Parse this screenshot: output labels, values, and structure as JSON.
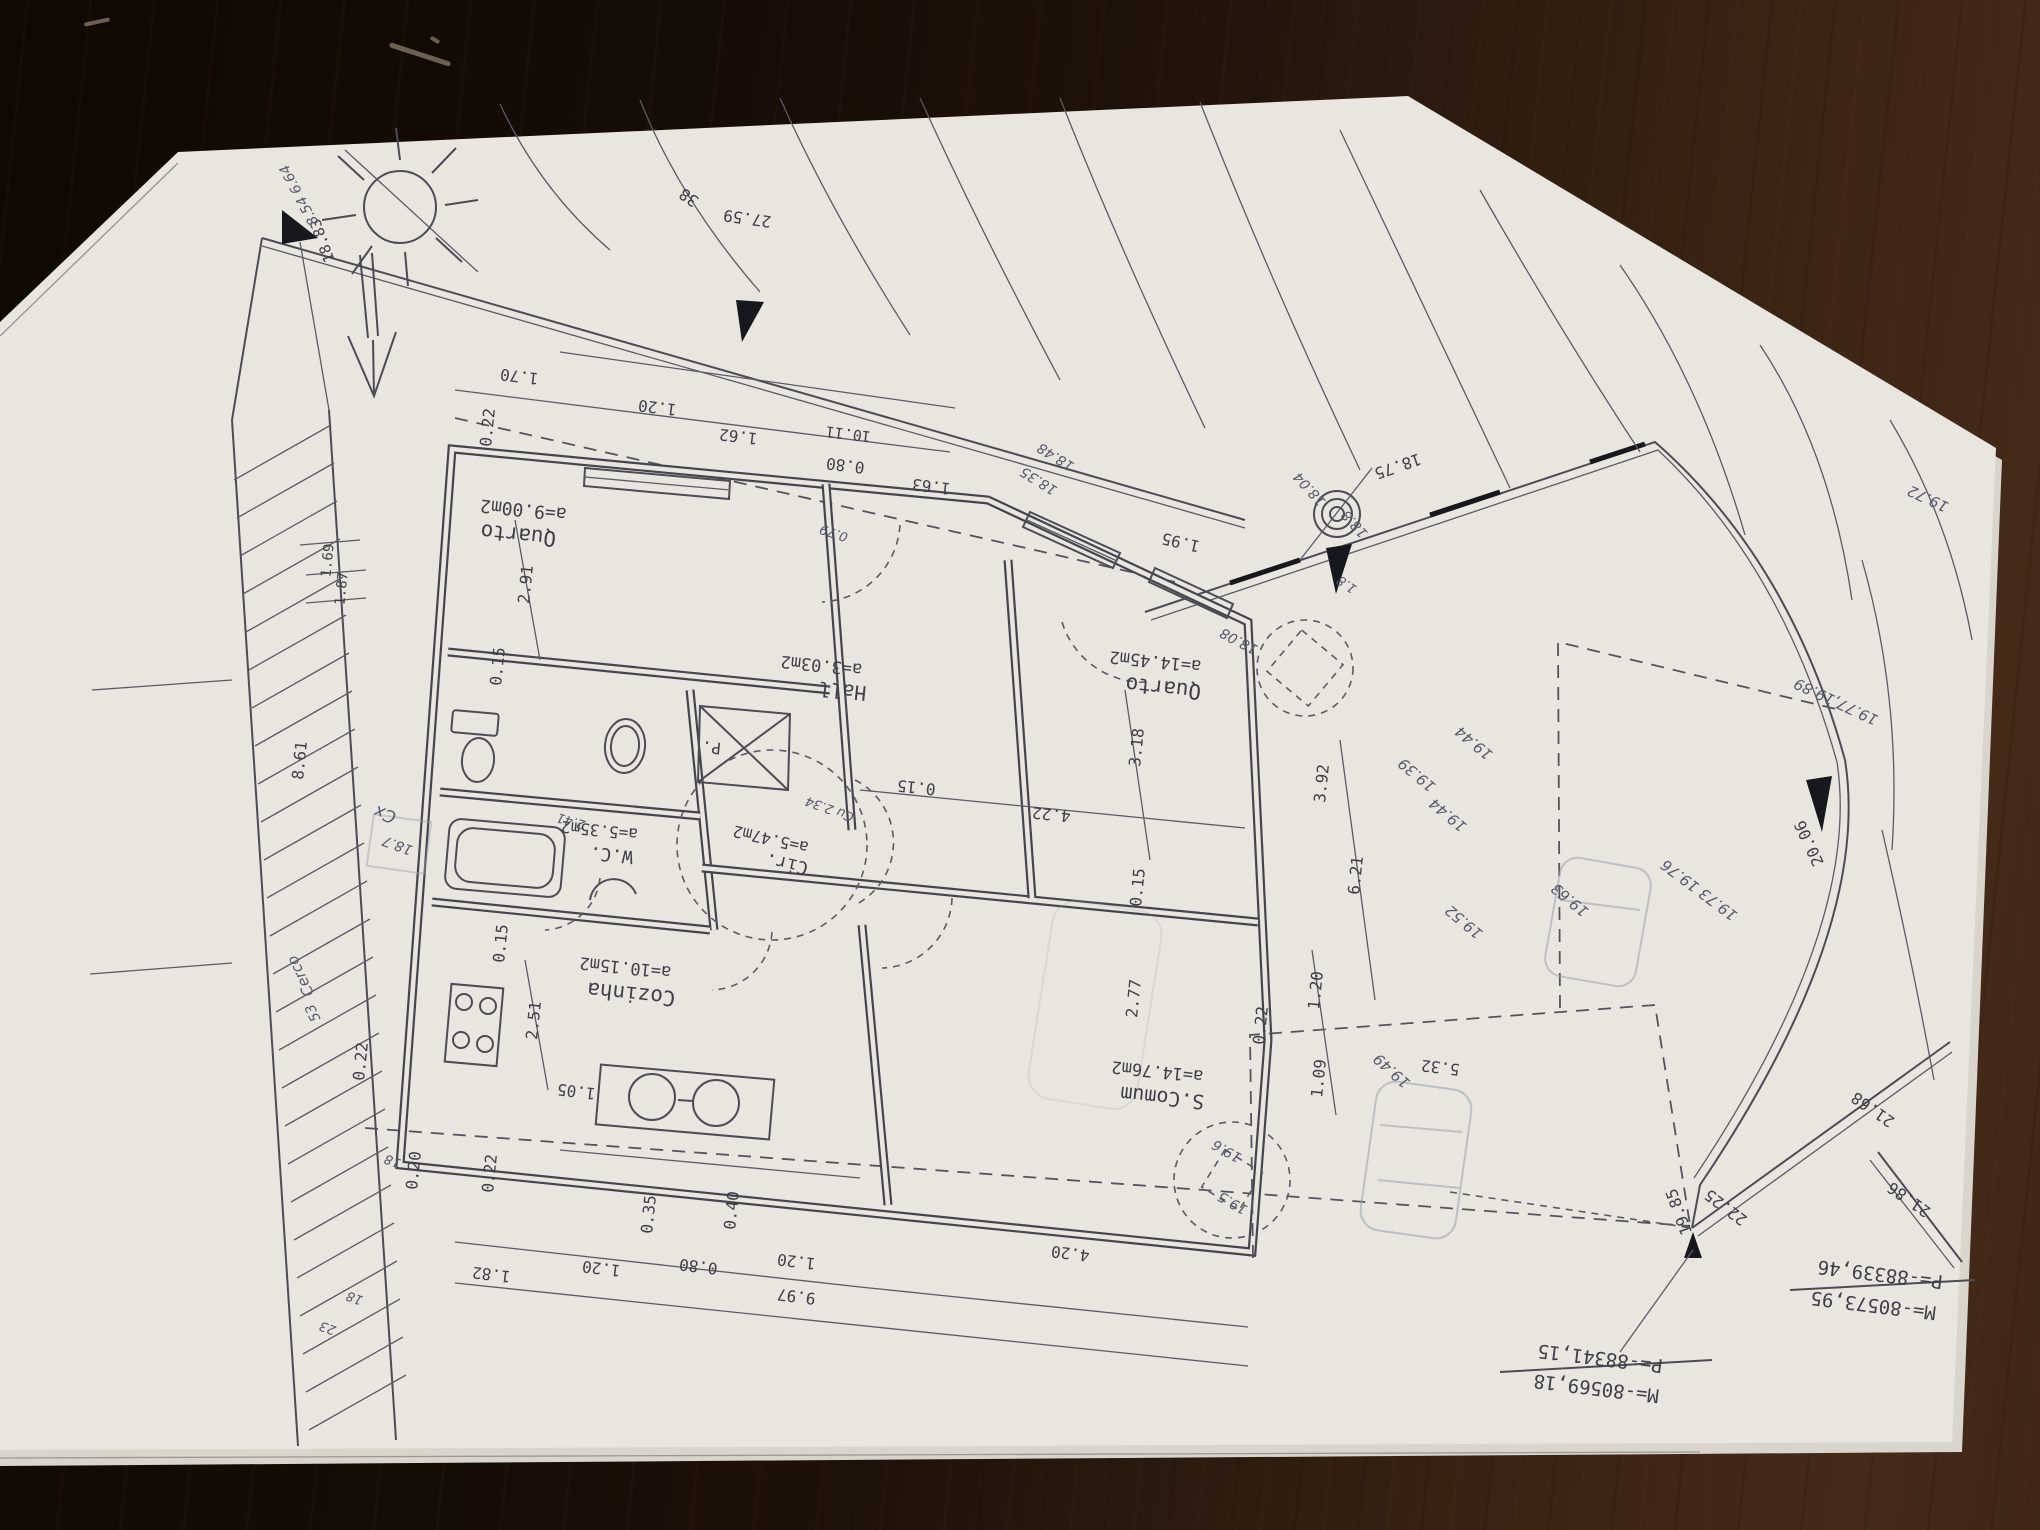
{
  "scene": {
    "paper_color": "#e9e6df",
    "ink_color": "#4b4c55",
    "pencil_color": "#9aa0ac",
    "table_color": "#2b1a0e"
  },
  "plan": {
    "printed_labels": [
      {
        "n": "room-area",
        "t": "a=9.00m2",
        "x": 524,
        "y": 504,
        "a": 186,
        "s": 18
      },
      {
        "n": "room-name",
        "t": "Quarto",
        "x": 519,
        "y": 528,
        "a": 186,
        "s": 21
      },
      {
        "n": "room-area",
        "t": "a=3.03m2",
        "x": 822,
        "y": 660,
        "a": 186,
        "s": 17
      },
      {
        "n": "room-name",
        "t": "Hall",
        "x": 843,
        "y": 684,
        "a": 186,
        "s": 20
      },
      {
        "n": "room-area",
        "t": "a=14.45m2",
        "x": 1156,
        "y": 656,
        "a": 186,
        "s": 17
      },
      {
        "n": "room-name",
        "t": "Quarto",
        "x": 1164,
        "y": 681,
        "a": 186,
        "s": 21
      },
      {
        "n": "room-area",
        "t": "a=5.35m2",
        "x": 600,
        "y": 825,
        "a": 186,
        "s": 16
      },
      {
        "n": "room-name",
        "t": "W.C.",
        "x": 612,
        "y": 849,
        "a": 186,
        "s": 18
      },
      {
        "n": "room-area",
        "t": "a=5.47m2",
        "x": 772,
        "y": 834,
        "a": 193,
        "s": 16
      },
      {
        "n": "room-name",
        "t": "Cir.",
        "x": 788,
        "y": 858,
        "a": 193,
        "s": 18
      },
      {
        "n": "room-area",
        "t": "a=10.15m2",
        "x": 626,
        "y": 962,
        "a": 186,
        "s": 17
      },
      {
        "n": "room-name",
        "t": "Cozinha",
        "x": 632,
        "y": 987,
        "a": 186,
        "s": 21
      },
      {
        "n": "room-area",
        "t": "a=14.76m2",
        "x": 1158,
        "y": 1066,
        "a": 186,
        "s": 17
      },
      {
        "n": "room-name",
        "t": "S.Comum",
        "x": 1163,
        "y": 1091,
        "a": 186,
        "s": 20
      },
      {
        "n": "room-name",
        "t": "P.",
        "x": 712,
        "y": 742,
        "a": 186,
        "s": 16
      },
      {
        "n": "dimension",
        "t": "0.22",
        "x": 493,
        "y": 428,
        "a": 276,
        "s": 16
      },
      {
        "n": "dimension",
        "t": "1.70",
        "x": 520,
        "y": 371,
        "a": 187,
        "s": 16
      },
      {
        "n": "dimension",
        "t": "1.20",
        "x": 658,
        "y": 402,
        "a": 187,
        "s": 16
      },
      {
        "n": "dimension",
        "t": "1.62",
        "x": 739,
        "y": 431,
        "a": 187,
        "s": 16
      },
      {
        "n": "dimension",
        "t": "10.11",
        "x": 849,
        "y": 429,
        "a": 187,
        "s": 15
      },
      {
        "n": "dimension",
        "t": "0.80",
        "x": 846,
        "y": 460,
        "a": 187,
        "s": 16
      },
      {
        "n": "dimension",
        "t": "1.63",
        "x": 932,
        "y": 481,
        "a": 187,
        "s": 16
      },
      {
        "n": "dimension",
        "t": "27.59",
        "x": 748,
        "y": 213,
        "a": 188,
        "s": 16
      },
      {
        "n": "dimension",
        "t": "38",
        "x": 692,
        "y": 193,
        "a": 215,
        "s": 16
      },
      {
        "n": "dimension",
        "t": "2.91",
        "x": 531,
        "y": 585,
        "a": 276,
        "s": 16
      },
      {
        "n": "dimension",
        "t": "0.15",
        "x": 503,
        "y": 667,
        "a": 276,
        "s": 16
      },
      {
        "n": "dimension",
        "t": "1.95",
        "x": 1182,
        "y": 537,
        "a": 193,
        "s": 16
      },
      {
        "n": "dimension",
        "t": "18.75",
        "x": 1396,
        "y": 461,
        "a": 161,
        "s": 16
      },
      {
        "n": "dimension",
        "t": "0.15",
        "x": 917,
        "y": 782,
        "a": 186,
        "s": 16
      },
      {
        "n": "dimension",
        "t": "4.22",
        "x": 1052,
        "y": 809,
        "a": 186,
        "s": 16
      },
      {
        "n": "dimension",
        "t": "3.18",
        "x": 1142,
        "y": 748,
        "a": 276,
        "s": 16
      },
      {
        "n": "dimension",
        "t": "0.15",
        "x": 1143,
        "y": 888,
        "a": 276,
        "s": 16
      },
      {
        "n": "dimension",
        "t": "3.92",
        "x": 1327,
        "y": 784,
        "a": 276,
        "s": 16
      },
      {
        "n": "dimension",
        "t": "6.21",
        "x": 1361,
        "y": 876,
        "a": 276,
        "s": 16
      },
      {
        "n": "dimension",
        "t": "2.77",
        "x": 1139,
        "y": 999,
        "a": 276,
        "s": 16
      },
      {
        "n": "dimension",
        "t": "1.20",
        "x": 1321,
        "y": 991,
        "a": 276,
        "s": 16
      },
      {
        "n": "dimension",
        "t": "0.22",
        "x": 1266,
        "y": 1026,
        "a": 276,
        "s": 16
      },
      {
        "n": "dimension",
        "t": "1.09",
        "x": 1324,
        "y": 1079,
        "a": 276,
        "s": 16
      },
      {
        "n": "dimension",
        "t": "5.32",
        "x": 1441,
        "y": 1062,
        "a": 187,
        "s": 16
      },
      {
        "n": "dimension",
        "t": "0.15",
        "x": 506,
        "y": 944,
        "a": 276,
        "s": 16
      },
      {
        "n": "dimension",
        "t": "2.51",
        "x": 539,
        "y": 1021,
        "a": 276,
        "s": 16
      },
      {
        "n": "dimension",
        "t": "0.22",
        "x": 366,
        "y": 1062,
        "a": 276,
        "s": 16
      },
      {
        "n": "dimension",
        "t": "0.20",
        "x": 419,
        "y": 1171,
        "a": 276,
        "s": 16
      },
      {
        "n": "dimension",
        "t": "0.22",
        "x": 495,
        "y": 1174,
        "a": 276,
        "s": 16
      },
      {
        "n": "dimension",
        "t": "1.05",
        "x": 577,
        "y": 1086,
        "a": 187,
        "s": 16
      },
      {
        "n": "dimension",
        "t": "1.82",
        "x": 492,
        "y": 1269,
        "a": 187,
        "s": 16
      },
      {
        "n": "dimension",
        "t": "1.20",
        "x": 602,
        "y": 1263,
        "a": 187,
        "s": 16
      },
      {
        "n": "dimension",
        "t": "0.35",
        "x": 654,
        "y": 1215,
        "a": 276,
        "s": 16
      },
      {
        "n": "dimension",
        "t": "0.80",
        "x": 699,
        "y": 1261,
        "a": 187,
        "s": 16
      },
      {
        "n": "dimension",
        "t": "0.40",
        "x": 737,
        "y": 1211,
        "a": 276,
        "s": 16
      },
      {
        "n": "dimension",
        "t": "1.20",
        "x": 797,
        "y": 1256,
        "a": 187,
        "s": 16
      },
      {
        "n": "dimension",
        "t": "4.20",
        "x": 1071,
        "y": 1248,
        "a": 187,
        "s": 16
      },
      {
        "n": "dimension",
        "t": "9.97",
        "x": 797,
        "y": 1291,
        "a": 187,
        "s": 16
      },
      {
        "n": "dimension",
        "t": "8.61",
        "x": 305,
        "y": 761,
        "a": 276,
        "s": 16
      },
      {
        "n": "dimension",
        "t": "1.69",
        "x": 332,
        "y": 561,
        "a": 276,
        "s": 14
      },
      {
        "n": "dimension",
        "t": "1.87",
        "x": 346,
        "y": 589,
        "a": 276,
        "s": 14
      },
      {
        "n": "dimension",
        "t": "20.06",
        "x": 1814,
        "y": 841,
        "a": 245,
        "s": 16
      },
      {
        "n": "dimension",
        "t": "19.85",
        "x": 1684,
        "y": 1210,
        "a": 250,
        "s": 16
      },
      {
        "n": "dimension",
        "t": "22.25",
        "x": 1729,
        "y": 1203,
        "a": 217,
        "s": 16
      },
      {
        "n": "dimension",
        "t": "21.68",
        "x": 1876,
        "y": 1105,
        "a": 215,
        "s": 16
      },
      {
        "n": "dimension",
        "t": "21.86",
        "x": 1912,
        "y": 1195,
        "a": 215,
        "s": 16
      },
      {
        "n": "dimension",
        "t": "18.83",
        "x": 327,
        "y": 239,
        "a": 250,
        "s": 15
      },
      {
        "n": "survey-coordinate",
        "t": "P=-88341,15",
        "x": 1601,
        "y": 1352,
        "a": 187,
        "s": 19
      },
      {
        "n": "survey-coordinate",
        "t": "M=-80569,18",
        "x": 1597,
        "y": 1382,
        "a": 187,
        "s": 19
      },
      {
        "n": "survey-coordinate",
        "t": "P=-88339,46",
        "x": 1881,
        "y": 1268,
        "a": 187,
        "s": 19
      },
      {
        "n": "survey-coordinate",
        "t": "M=-80573,95",
        "x": 1874,
        "y": 1299,
        "a": 187,
        "s": 19
      }
    ],
    "handwritten_labels": [
      {
        "n": "handwritten-level",
        "t": "8.54 6.64",
        "x": 303,
        "y": 193,
        "a": 242,
        "s": 14
      },
      {
        "n": "handwritten-level",
        "t": "18.48",
        "x": 1058,
        "y": 453,
        "a": 212,
        "s": 14
      },
      {
        "n": "handwritten-level",
        "t": "18.35",
        "x": 1041,
        "y": 477,
        "a": 212,
        "s": 14
      },
      {
        "n": "handwritten-level",
        "t": "18.04",
        "x": 1313,
        "y": 486,
        "a": 228,
        "s": 14
      },
      {
        "n": "handwritten-level",
        "t": "18.8",
        "x": 1358,
        "y": 521,
        "a": 228,
        "s": 14
      },
      {
        "n": "handwritten-level",
        "t": "18.08",
        "x": 1241,
        "y": 637,
        "a": 208,
        "s": 14
      },
      {
        "n": "handwritten-level",
        "t": "1.8",
        "x": 1349,
        "y": 581,
        "a": 215,
        "s": 13
      },
      {
        "n": "handwritten-level",
        "t": "19.44",
        "x": 1477,
        "y": 739,
        "a": 220,
        "s": 15
      },
      {
        "n": "handwritten-level",
        "t": "19.39",
        "x": 1420,
        "y": 771,
        "a": 220,
        "s": 15
      },
      {
        "n": "handwritten-level",
        "t": "19.44",
        "x": 1451,
        "y": 811,
        "a": 220,
        "s": 15
      },
      {
        "n": "handwritten-level",
        "t": "19.52",
        "x": 1467,
        "y": 918,
        "a": 220,
        "s": 15
      },
      {
        "n": "handwritten-level",
        "t": "19.49",
        "x": 1395,
        "y": 1067,
        "a": 222,
        "s": 15
      },
      {
        "n": "handwritten-level",
        "t": "19.63",
        "x": 1573,
        "y": 896,
        "a": 220,
        "s": 15
      },
      {
        "n": "handwritten-level",
        "t": "19.73 19.76",
        "x": 1702,
        "y": 886,
        "a": 217,
        "s": 15
      },
      {
        "n": "handwritten-level",
        "t": "19.77,19.89",
        "x": 1838,
        "y": 697,
        "a": 205,
        "s": 15
      },
      {
        "n": "handwritten-level",
        "t": "19.72",
        "x": 1930,
        "y": 494,
        "a": 205,
        "s": 15
      },
      {
        "n": "handwritten-level",
        "t": "19.6",
        "x": 1229,
        "y": 1147,
        "a": 210,
        "s": 14
      },
      {
        "n": "handwritten-level",
        "t": "19.5",
        "x": 1235,
        "y": 1199,
        "a": 210,
        "s": 14
      },
      {
        "n": "handwritten-note",
        "t": "Cx",
        "x": 387,
        "y": 809,
        "a": 200,
        "s": 17
      },
      {
        "n": "handwritten-note",
        "t": "18.7",
        "x": 399,
        "y": 841,
        "a": 200,
        "s": 14
      },
      {
        "n": "handwritten-note",
        "t": "Cerco",
        "x": 305,
        "y": 974,
        "a": 245,
        "s": 15
      },
      {
        "n": "handwritten-note",
        "t": "53",
        "x": 317,
        "y": 1011,
        "a": 245,
        "s": 14
      },
      {
        "n": "handwritten-level",
        "t": "18",
        "x": 394,
        "y": 1157,
        "a": 200,
        "s": 13
      },
      {
        "n": "handwritten-level",
        "t": "18",
        "x": 356,
        "y": 1294,
        "a": 200,
        "s": 13
      },
      {
        "n": "handwritten-level",
        "t": "23",
        "x": 329,
        "y": 1324,
        "a": 200,
        "s": 13
      },
      {
        "n": "handwritten-note",
        "t": "0.79",
        "x": 835,
        "y": 529,
        "a": 198,
        "s": 13
      },
      {
        "n": "handwritten-note",
        "t": "Cu 2.34",
        "x": 831,
        "y": 805,
        "a": 200,
        "s": 13
      },
      {
        "n": "handwritten-note",
        "t": "2.41",
        "x": 572,
        "y": 817,
        "a": 196,
        "s": 13
      }
    ]
  }
}
